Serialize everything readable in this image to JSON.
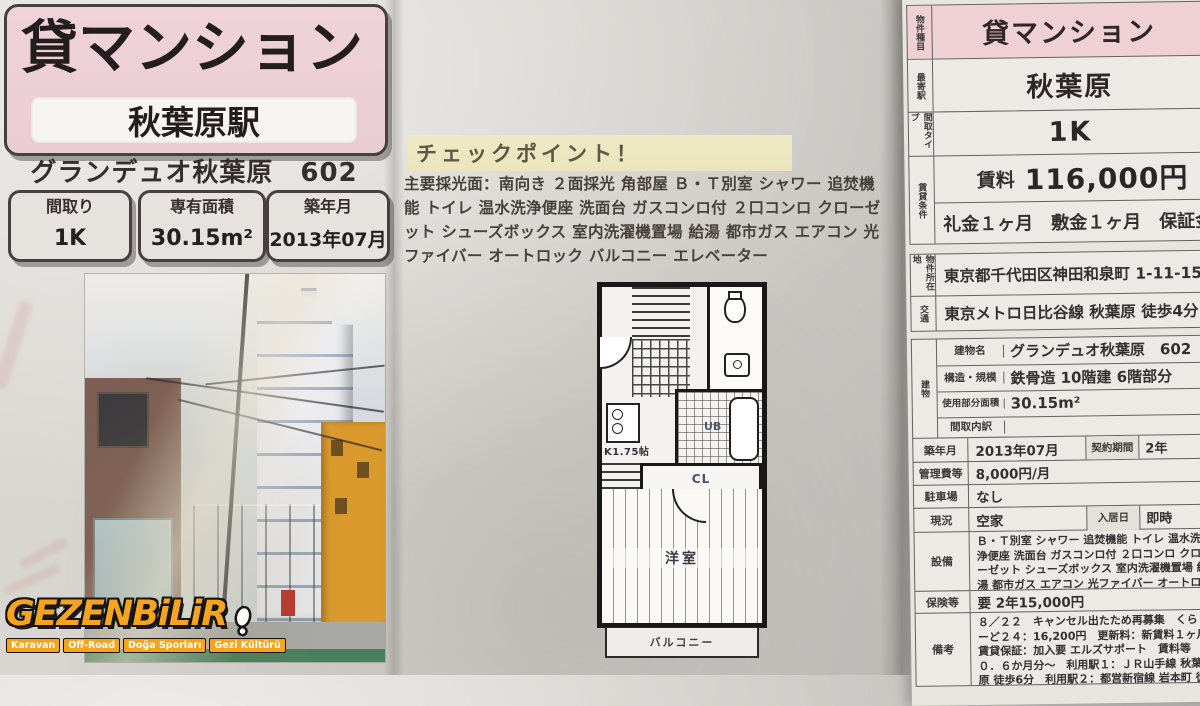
{
  "flyer": {
    "title": "貸マンション",
    "station": "秋葉原駅",
    "building_line": "グランデュオ秋葉原　602",
    "spec_boxes": [
      {
        "label": "間取り",
        "value": "1K"
      },
      {
        "label": "専有面積",
        "value": "30.15m²"
      },
      {
        "label": "築年月",
        "value": "2013年07月"
      }
    ]
  },
  "checkpoint": {
    "heading": "チェックポイント！",
    "body": "主要採光面：南向き ２面採光 角部屋 Ｂ・Ｔ別室 シャワー 追焚機能 トイレ 温水洗浄便座 洗面台 ガスコンロ付 ２口コンロ クローゼット シューズボックス 室内洗濯機置場 給湯 都市ガス エアコン 光ファイバー オートロック バルコニー エレベーター"
  },
  "floorplan": {
    "kitchen_label": "K1.75帖",
    "bath_label": "UB",
    "closet_label": "CL",
    "room_label": "洋室",
    "balcony_label": "バルコニー"
  },
  "table": {
    "type_row": {
      "label": "物件種目",
      "value": "貸マンション"
    },
    "station_row": {
      "label": "最寄駅",
      "value": "秋葉原"
    },
    "layout_row": {
      "label": "間取タイプ",
      "value": "1K"
    },
    "rent_group_label": "賃貸条件",
    "rent_row": {
      "label": "賃料",
      "value": "116,000円"
    },
    "fees_row": "礼金１ヶ月　敷金１ヶ月　保証金な",
    "address_row": {
      "label": "物件所在地",
      "value": "東京都千代田区神田和泉町 1-11-15"
    },
    "access_row": {
      "label": "交通",
      "value": "東京メトロ日比谷線 秋葉原 徒歩4分"
    },
    "building_group": {
      "label": "建物",
      "rows": [
        {
          "label": "建物名",
          "value": "グランデュオ秋葉原　602"
        },
        {
          "label": "構造・規模",
          "value": "鉄骨造 10階建 6階部分"
        },
        {
          "label": "使用部分面積",
          "value": "30.15m²"
        },
        {
          "label": "間取内訳",
          "value": ""
        }
      ]
    },
    "detail_rows": [
      {
        "label": "築年月",
        "value": "2013年07月",
        "label2": "契約期間",
        "value2": "2年"
      },
      {
        "label": "管理費等",
        "value": "8,000円/月"
      },
      {
        "label": "駐車場",
        "value": "なし"
      },
      {
        "label": "現況",
        "value": "空家",
        "label2": "入居日",
        "value2": "即時"
      },
      {
        "label": "設備",
        "value": "Ｂ・Ｔ別室 シャワー 追焚機能 トイレ 温水洗浄便座 洗面台 ガスコンロ付 ２口コンロ クローゼット シューズボックス 室内洗濯機置場 給湯 都市ガス エアコン 光ファイバー オートロック バルコニー エレベーター"
      },
      {
        "label": "保険等",
        "value": "要 2年15,000円"
      },
      {
        "label": "備考",
        "value": "８／２２　キャンセル出たため再募集　くらしーど２４：16,200円　更新料：新賃料１ヶ月　賃貸保証：加入要 エルズサポート　賃料等０．６か月分～　利用駅１：ＪＲ山手線 秋葉原 徒歩6分　利用駅２：都営新宿線 岩本町 徒歩7分"
      }
    ]
  },
  "watermark": {
    "brand": "GEZENBiLiR",
    "tags": [
      "Karavan",
      "Off-Road",
      "Doğa Sporları",
      "Gezi Kültürü"
    ]
  },
  "colors": {
    "header_pink": "#eed0d5",
    "highlight_yellow": "#ebe4bc",
    "brand_orange": "#f6a41e"
  }
}
